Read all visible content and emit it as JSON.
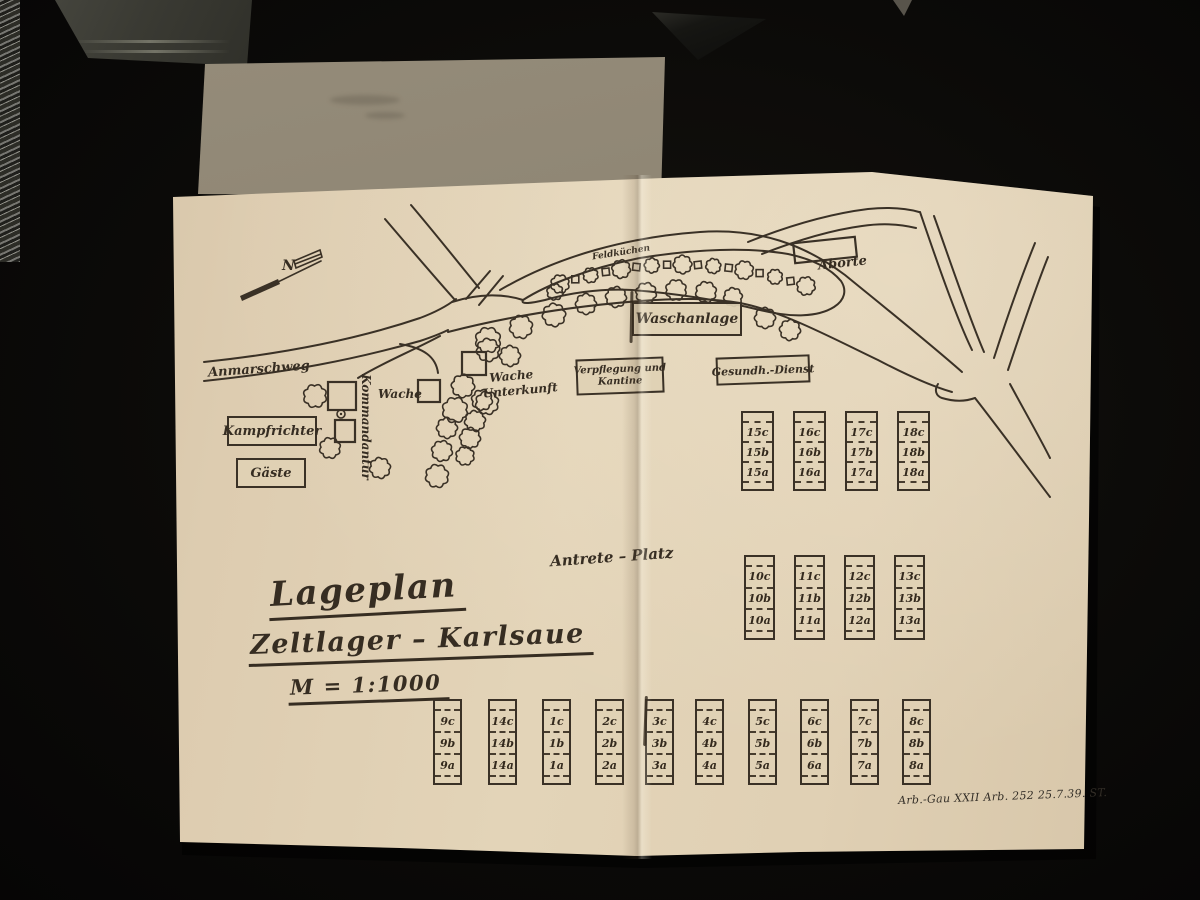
{
  "title_block": {
    "line1": "Lageplan",
    "line2": "Zeltlager – Karlsaue",
    "scale": "M = 1:1000"
  },
  "labels": {
    "north": "N",
    "anmarschweg": "Anmarschweg",
    "kampfrichter": "Kampfrichter",
    "gaeste": "Gäste",
    "kommandantur": "Kommandantur",
    "wache": "Wache",
    "wache_unterkunft_line1": "Wache",
    "wache_unterkunft_line2": "Unterkunft",
    "feldkuechen": "Feldküchen",
    "waschanlage": "Waschanlage",
    "verpflegung_line1": "Verpflegung und",
    "verpflegung_line2": "Kantine",
    "gesundheitsdienst": "Gesundh.-Dienst",
    "aborte": "Aborte",
    "antreteplatz": "Antrete – Platz"
  },
  "footer": "Arb.-Gau XXII Arb. 252 25.7.39. ST.",
  "tent_groups": {
    "north_block": {
      "columns": [
        [
          "15c",
          "15b",
          "15a"
        ],
        [
          "16c",
          "16b",
          "16a"
        ],
        [
          "17c",
          "17b",
          "17a"
        ],
        [
          "18c",
          "18b",
          "18a"
        ]
      ]
    },
    "middle_block": {
      "columns": [
        [
          "10c",
          "10b",
          "10a"
        ],
        [
          "11c",
          "11b",
          "11a"
        ],
        [
          "12c",
          "12b",
          "12a"
        ],
        [
          "13c",
          "13b",
          "13a"
        ]
      ]
    },
    "south_block": {
      "columns": [
        [
          "9c",
          "9b",
          "9a"
        ],
        [
          "14c",
          "14b",
          "14a"
        ],
        [
          "1c",
          "1b",
          "1a"
        ],
        [
          "2c",
          "2b",
          "2a"
        ],
        [
          "3c",
          "3b",
          "3a"
        ],
        [
          "4c",
          "4b",
          "4a"
        ],
        [
          "5c",
          "5b",
          "5a"
        ],
        [
          "6c",
          "6b",
          "6a"
        ],
        [
          "7c",
          "7b",
          "7a"
        ],
        [
          "8c",
          "8b",
          "8a"
        ]
      ]
    }
  },
  "colors": {
    "paper": "#e0d0b4",
    "ink": "#3a3126",
    "background": "#0b0a08",
    "envelope": "#8d8472"
  }
}
